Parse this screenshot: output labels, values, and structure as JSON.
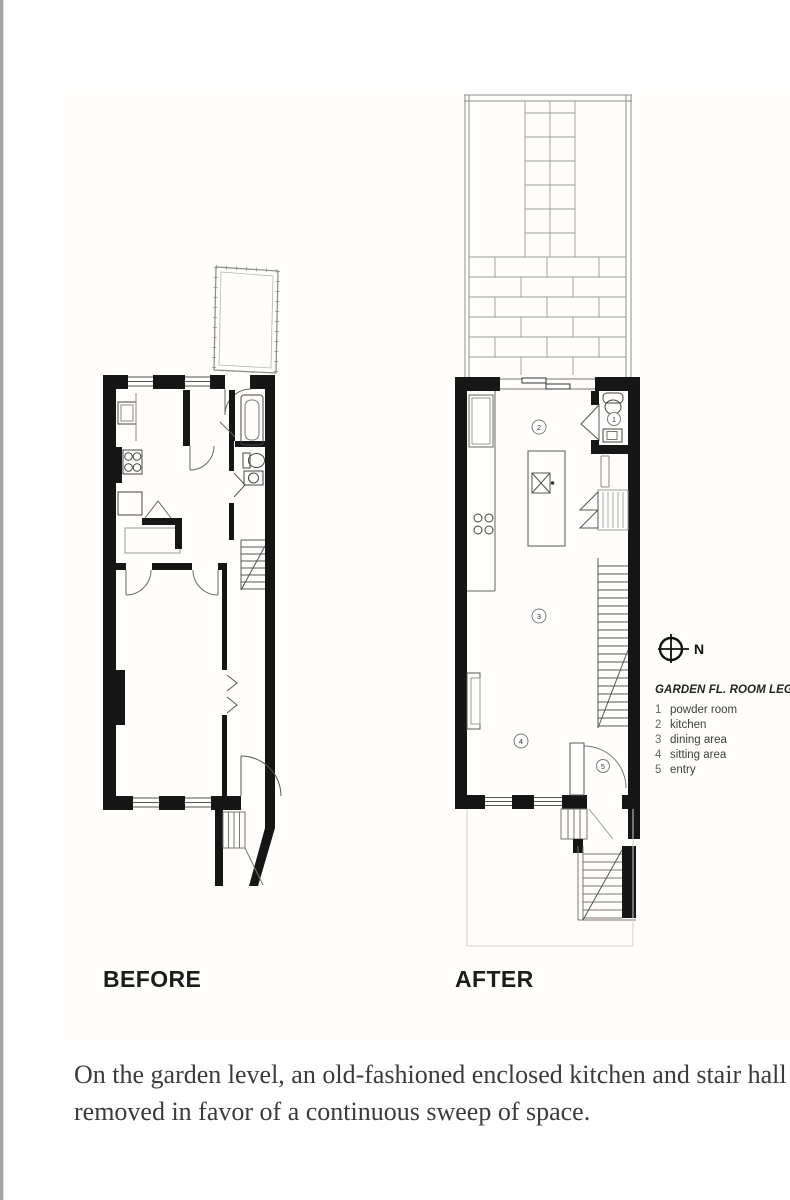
{
  "page": {
    "caption": {
      "line1": "On the garden level, an old-fashioned enclosed kitchen and stair hall were",
      "line2": "removed in favor of a continuous sweep of space."
    }
  },
  "figure": {
    "before_label": "BEFORE",
    "after_label": "AFTER",
    "compass_label": "N",
    "legend": {
      "title": "GARDEN FL. ROOM LEGEND",
      "items": [
        {
          "num": "1",
          "label": "powder room"
        },
        {
          "num": "2",
          "label": "kitchen"
        },
        {
          "num": "3",
          "label": "dining area"
        },
        {
          "num": "4",
          "label": "sitting area"
        },
        {
          "num": "5",
          "label": "entry"
        }
      ]
    },
    "room_markers": {
      "powder_room": "1",
      "kitchen": "2",
      "dining_area": "3",
      "sitting_area": "4",
      "entry": "5"
    }
  },
  "colors": {
    "wall": "#161616",
    "label_text": "#1c1c1c",
    "caption_text": "#3b3b3b",
    "plan_line": "#555555",
    "faint_line": "#9a9a9a"
  }
}
